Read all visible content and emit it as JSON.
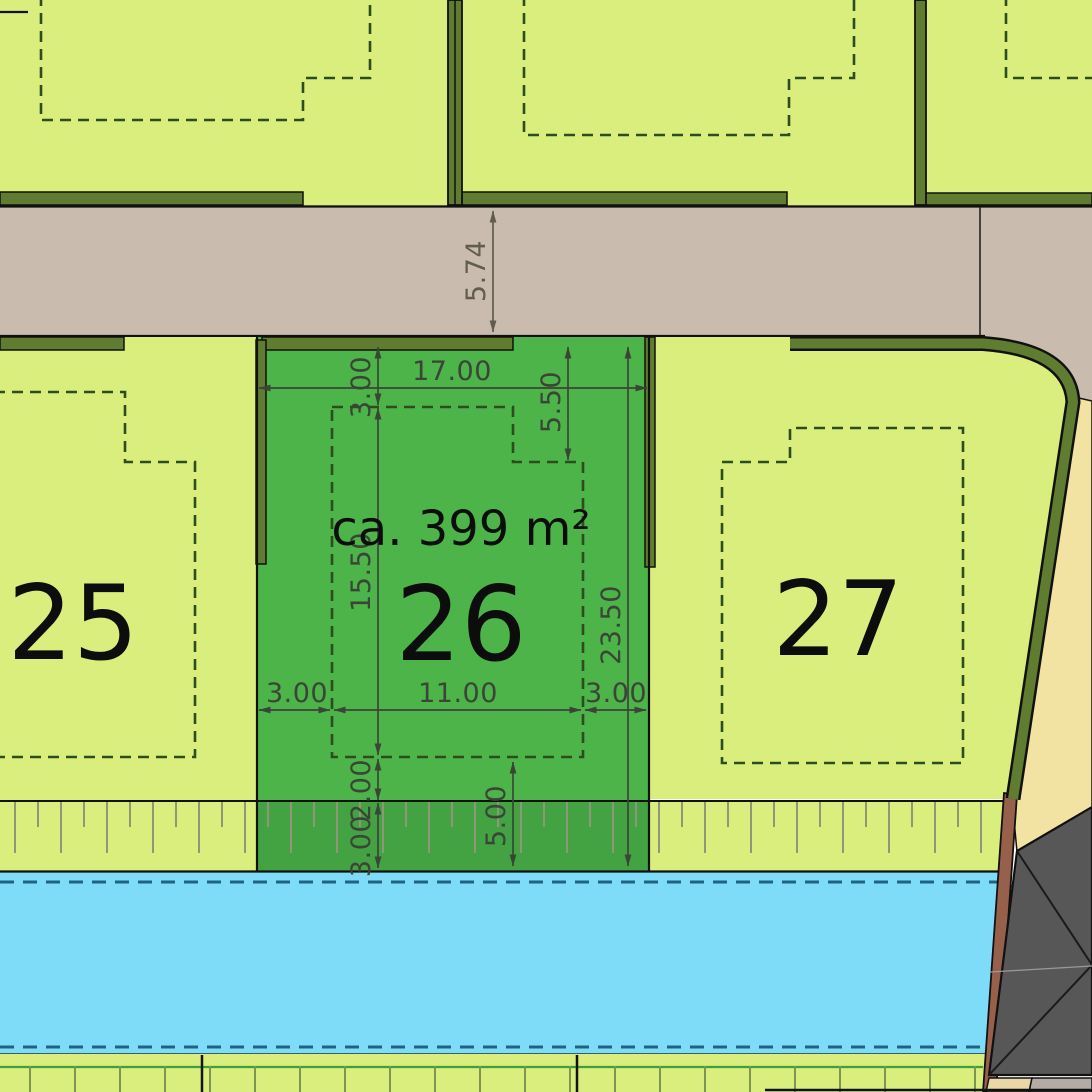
{
  "document": {
    "type": "site-development-plan",
    "highlighted_plot": "26"
  },
  "plots": {
    "p25": {
      "number": "25"
    },
    "p26": {
      "number": "26",
      "area": "ca. 399 m²"
    },
    "p27": {
      "number": "27"
    }
  },
  "dimensions": {
    "road_width": "5.74",
    "plot_frontage": "17.00",
    "front_setback": "3.00",
    "envelope_depth": "15.50",
    "gap_below_envelope": "2.00",
    "slope_strip": "3.00",
    "garage_notch_depth": "5.50",
    "plot_depth": "23.50",
    "rear_depth": "5.00",
    "side_setback_left": "3.00",
    "envelope_width": "11.00",
    "side_setback_right": "3.00"
  },
  "colors": {
    "plot_light_green": "#d9ee7d",
    "plot_selected_green": "#4cb449",
    "road_tan": "#c9bcae",
    "verge_pale_yellow": "#f3e3a2",
    "ditch_blue": "#7edcf8",
    "hedge_olive": "#5f7c31",
    "building_gray": "#575757",
    "wall_brown": "#96604a",
    "envelope_dash_green": "#2e4d1d",
    "dimension_ink": "#3b4537"
  }
}
